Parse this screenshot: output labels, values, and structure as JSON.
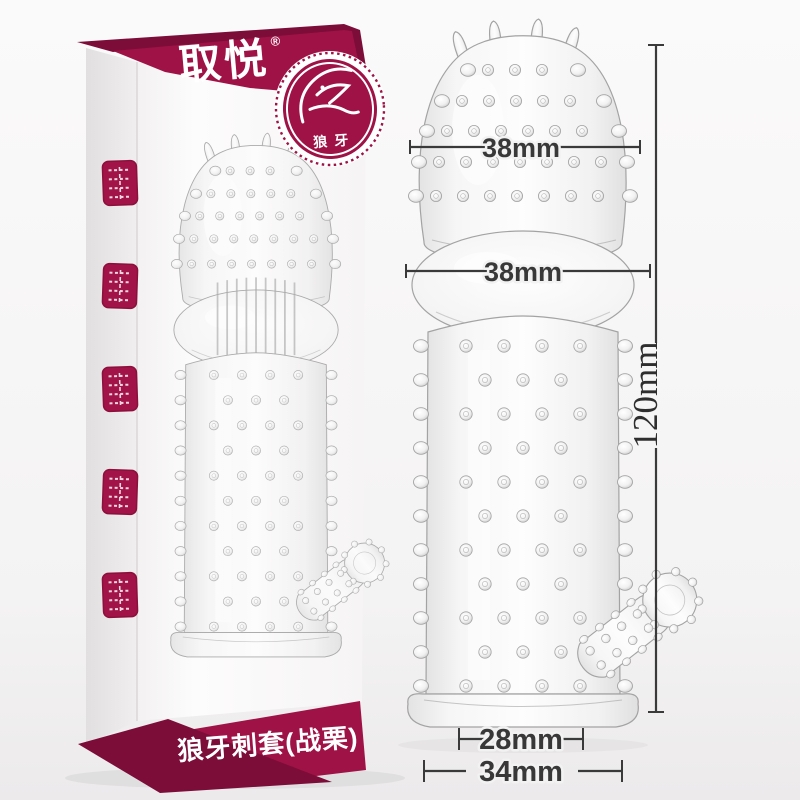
{
  "box": {
    "brand_logo": "取悦",
    "trademark_symbol": "®",
    "badge": {
      "label": "狼牙",
      "icon": "wolf-icon"
    },
    "bottom_banner_label": "狼牙刺套(战栗)",
    "side_seals": [
      "seal-stamp",
      "seal-stamp",
      "seal-stamp",
      "seal-stamp",
      "seal-stamp"
    ]
  },
  "annotations": {
    "head_width": "38mm",
    "chamber_width": "38mm",
    "total_length": "120mm",
    "inner_diameter": "28mm",
    "base_width": "34mm"
  },
  "colors": {
    "banner": "#9f1245",
    "banner_dark": "#7c0c38",
    "seal": "#a21447",
    "dimension_line": "#3a3a3a",
    "background_top": "#fbfafa",
    "background_bottom": "#eceaeb"
  }
}
